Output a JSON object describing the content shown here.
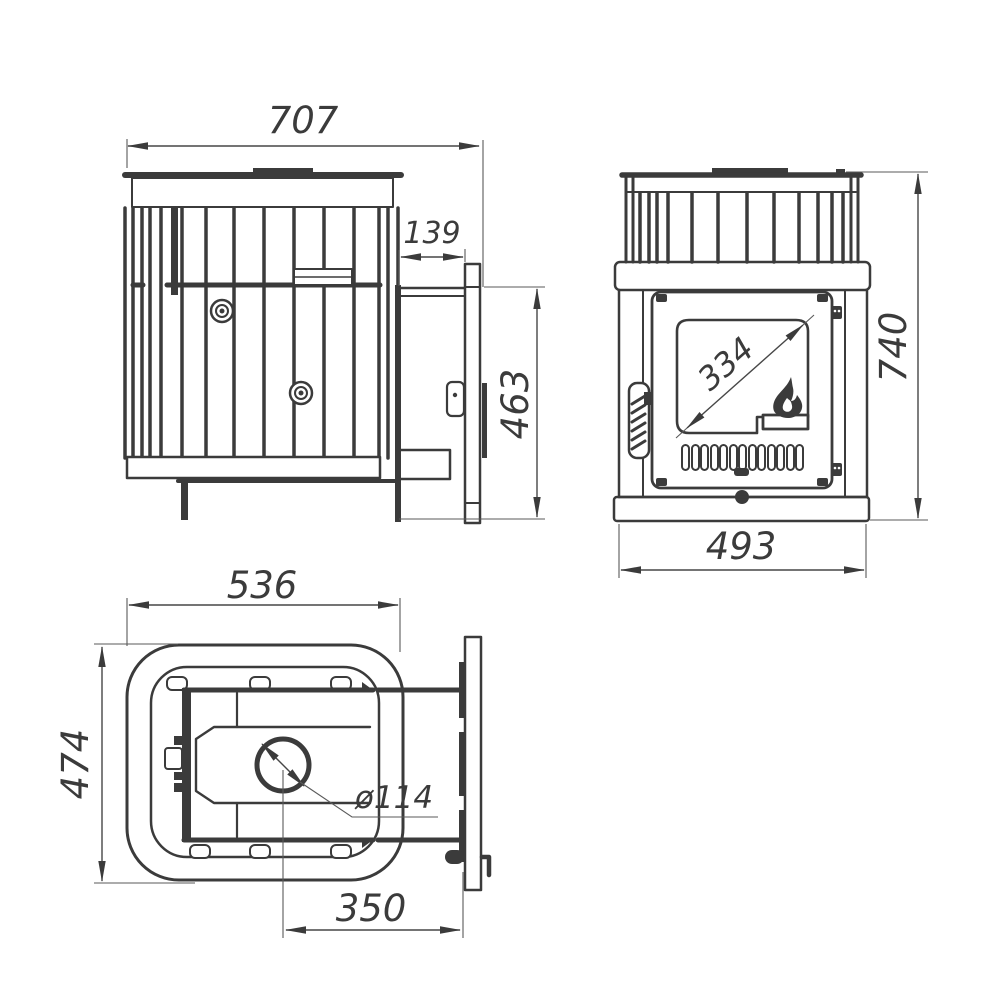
{
  "drawing": {
    "background_color": "#ffffff",
    "line_color": "#3b3b3b",
    "views": {
      "side_view": {
        "overall_width": "707",
        "tunnel_length": "139",
        "mount_flange_height": "463"
      },
      "front_view": {
        "glass_diagonal": "334",
        "overall_height": "740",
        "overall_width": "493"
      },
      "top_view": {
        "body_width": "536",
        "body_depth": "474",
        "chimney_diameter": "ø114",
        "chimney_axis_offset": "350"
      }
    }
  }
}
